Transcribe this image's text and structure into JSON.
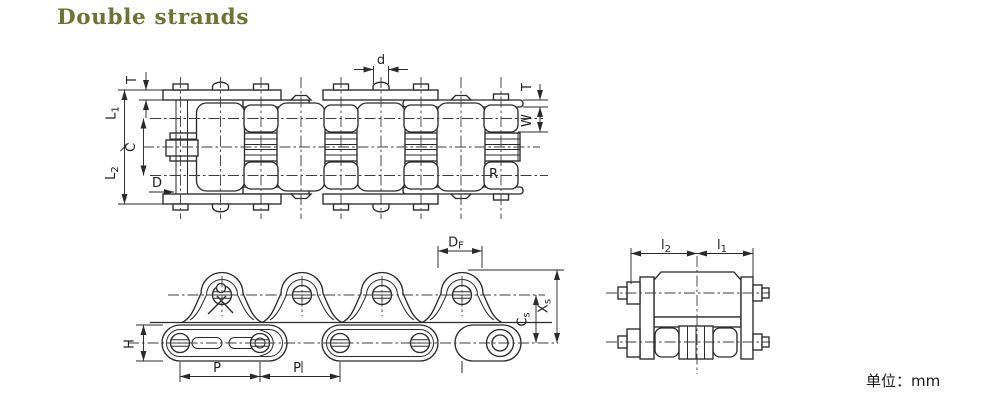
{
  "title": "Double strands",
  "unit_label": "单位：mm",
  "colors": {
    "title": "#6e7233",
    "line": "#2b2b2b",
    "background": "#ffffff"
  },
  "top_view": {
    "description": "plan view of double strand roller chain",
    "dims": {
      "T_left": "T",
      "L1": {
        "main": "L",
        "sub": "1"
      },
      "C": "C",
      "L2": {
        "main": "L",
        "sub": "2"
      },
      "D": "D",
      "d": "d",
      "T_right": "T",
      "W": "W",
      "R": "R"
    }
  },
  "side_view": {
    "description": "side elevation of chain with peaked plates",
    "dims": {
      "DF": {
        "main": "D",
        "sub": "F"
      },
      "Xs": {
        "main": "X",
        "sub": "s"
      },
      "Cs": {
        "main": "C",
        "sub": "s"
      },
      "H": "H",
      "P1": "P",
      "P2": "P"
    }
  },
  "section_view": {
    "description": "end cross-section of link",
    "dims": {
      "l2": {
        "main": "l",
        "sub": "2"
      },
      "l1": {
        "main": "l",
        "sub": "1"
      }
    }
  }
}
